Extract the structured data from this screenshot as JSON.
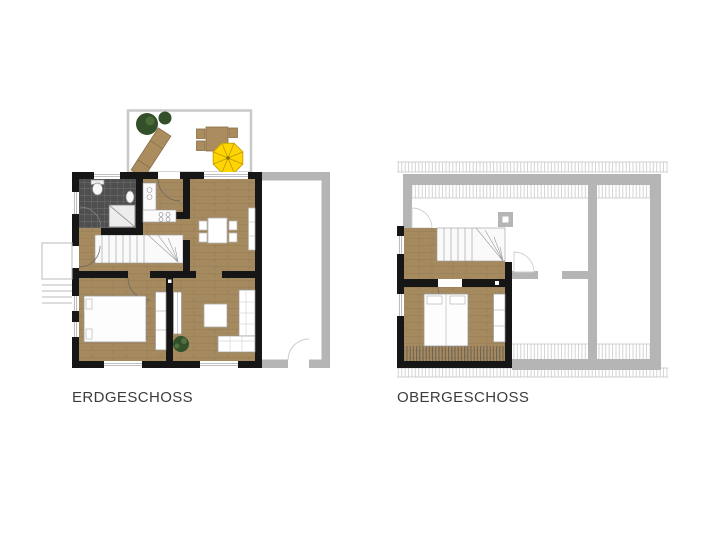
{
  "labels": {
    "ground_floor": "ERDGESCHOSS",
    "upper_floor": "OBERGESCHOSS"
  },
  "colors": {
    "wall": "#161616",
    "wood_floor": "#a5895f",
    "annex_gray": "#b5b5b5",
    "tile_dark": "#4f4f4f",
    "umbrella_yellow": "#ffd400",
    "plant_green": "#34502a",
    "terrace_wood": "#ab8c5f",
    "furniture_white": "#fdfdfd",
    "outline_gray": "#c9c9c9",
    "label_text": "#3c3c3c",
    "background": "#ffffff"
  }
}
